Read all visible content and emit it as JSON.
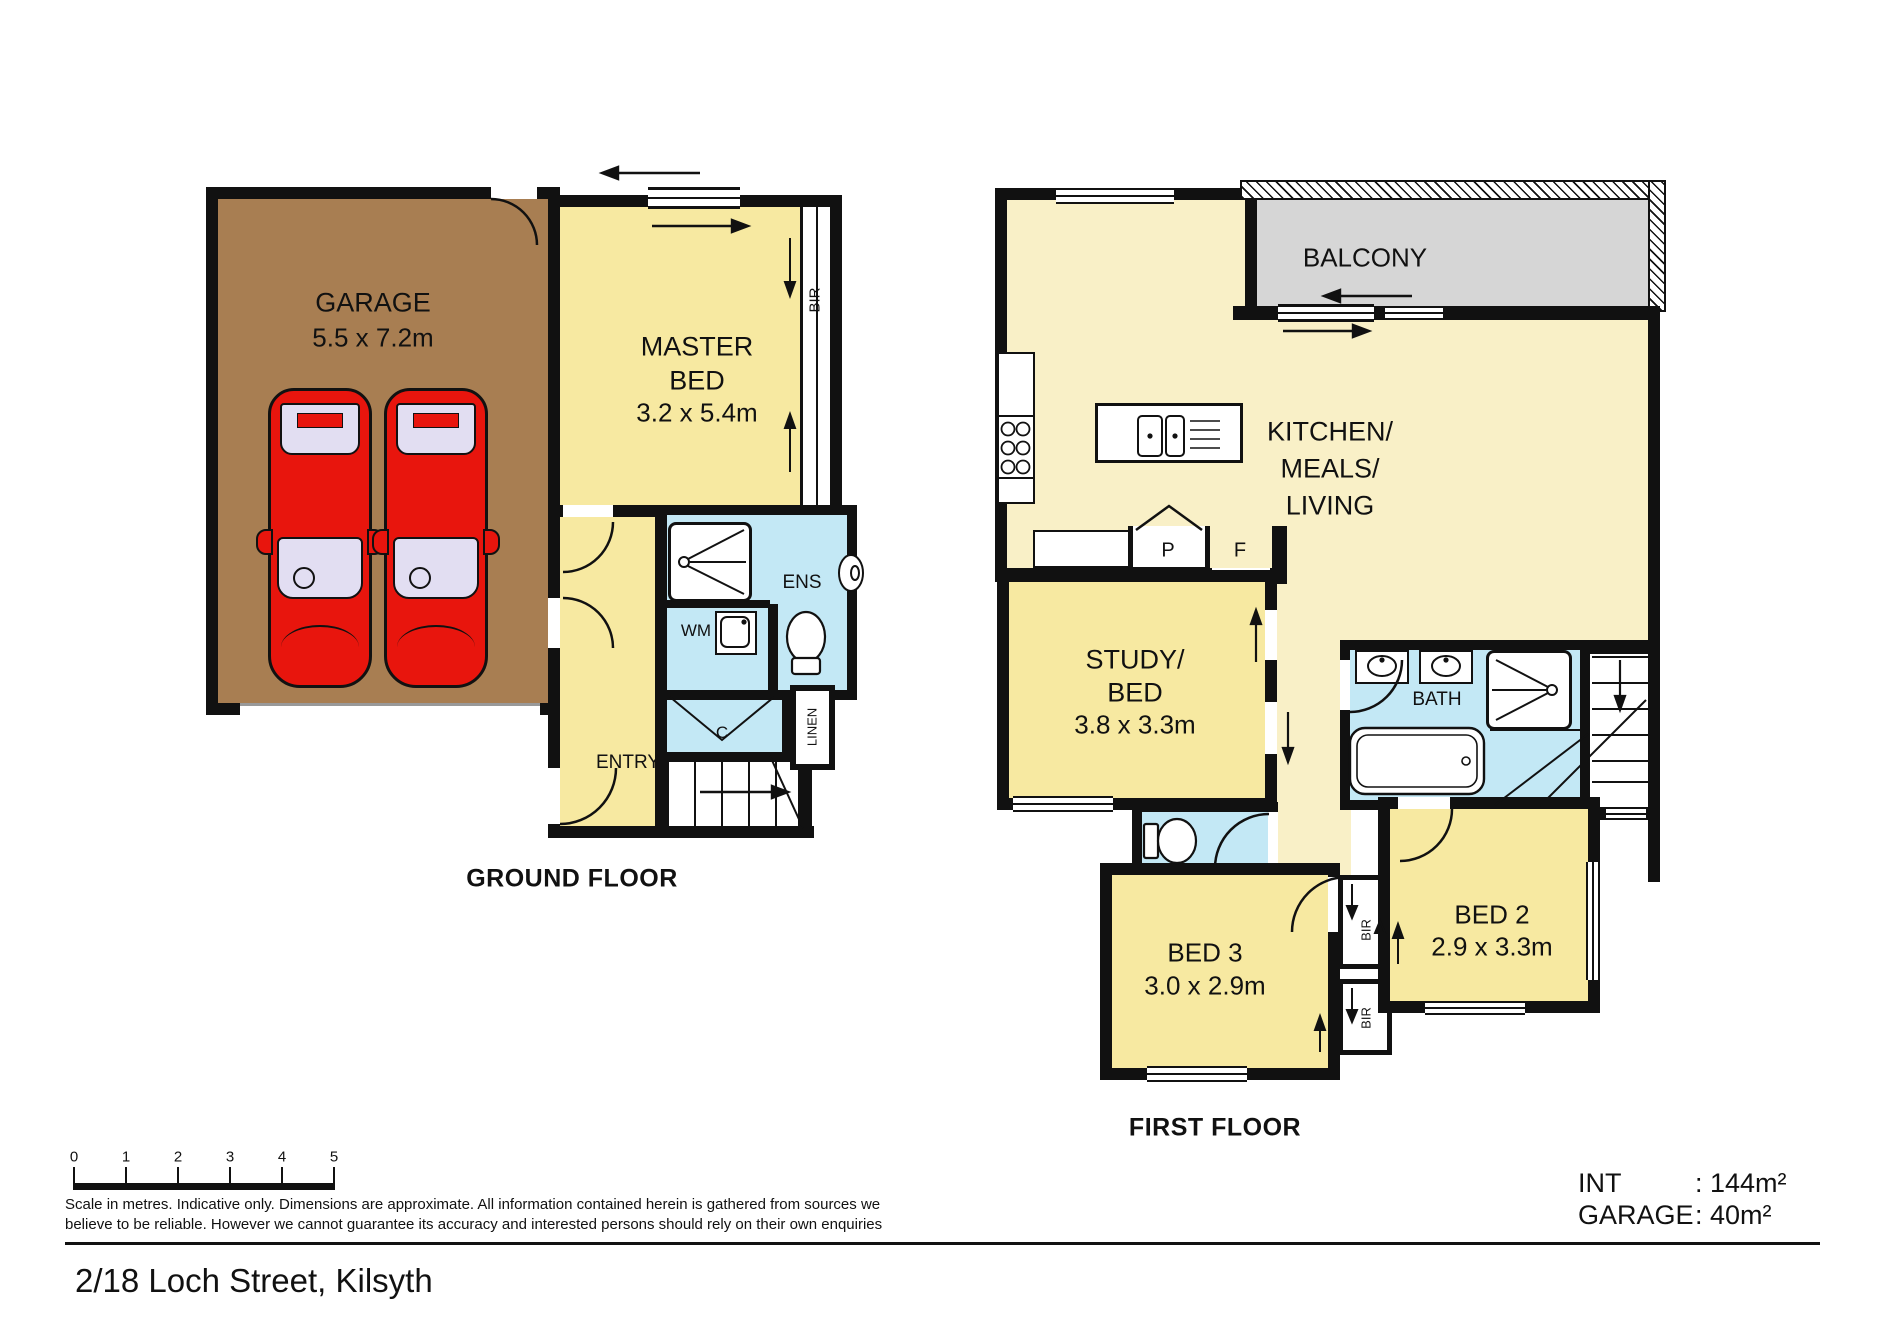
{
  "meta": {
    "address": "2/18 Loch Street, Kilsyth"
  },
  "ground_floor": {
    "title": "GROUND FLOOR",
    "rooms": {
      "garage": {
        "name": "GARAGE",
        "dims": "5.5 x 7.2m"
      },
      "master_bed": {
        "line1": "MASTER",
        "line2": "BED",
        "dims": "3.2 x 5.4m"
      },
      "bir": {
        "name": "BIR"
      },
      "ens": {
        "name": "ENS"
      },
      "wm": {
        "name": "WM"
      },
      "cupboard": {
        "name": "C"
      },
      "linen": {
        "name": "LINEN"
      },
      "entry": {
        "name": "ENTRY"
      }
    }
  },
  "first_floor": {
    "title": "FIRST FLOOR",
    "rooms": {
      "balcony": {
        "name": "BALCONY"
      },
      "kitchen_meals_living": {
        "line1": "KITCHEN/",
        "line2": "MEALS/",
        "line3": "LIVING"
      },
      "pantry": {
        "name": "P"
      },
      "fridge": {
        "name": "F"
      },
      "study": {
        "line1": "STUDY/",
        "line2": "BED",
        "dims": "3.8 x 3.3m"
      },
      "bath": {
        "name": "BATH"
      },
      "bed3": {
        "name": "BED 3",
        "dims": "3.0 x 2.9m"
      },
      "bed2": {
        "name": "BED 2",
        "dims": "2.9 x 3.3m"
      },
      "bir_upper": {
        "name": "BIR"
      },
      "bir_lower": {
        "name": "BIR"
      }
    }
  },
  "scale_bar": {
    "ticks": [
      "0",
      "1",
      "2",
      "3",
      "4",
      "5"
    ]
  },
  "disclaimer": {
    "line1": "Scale in metres. Indicative only.  Dimensions are approximate.  All information contained herein is gathered from sources we",
    "line2": "believe to be reliable.  However we cannot guarantee its accuracy and interested persons should rely on their own enquiries"
  },
  "areas": {
    "int_label": "INT",
    "int_value": ": 144m²",
    "garage_label": "GARAGE",
    "garage_value": ": 40m²"
  },
  "fixtures": {
    "cars": "car-icon",
    "shower": "shower-icon",
    "toilet": "toilet-icon",
    "basin": "basin-icon",
    "washing_machine": "washing-machine-icon",
    "kitchen_sink": "kitchen-sink-icon",
    "stove": "stove-icon",
    "bathtub": "bathtub-icon",
    "stairs": "stairs-icon",
    "door": "door-arc-icon",
    "window": "window-icon"
  },
  "colors": {
    "wall": "#111111",
    "garage_floor": "#A87E52",
    "room_yellow": "#F7E9A1",
    "living_cream": "#F9F0C7",
    "wet_blue": "#C3E8F5",
    "balcony_grey": "#D6D6D6",
    "car_red": "#E8150D"
  }
}
